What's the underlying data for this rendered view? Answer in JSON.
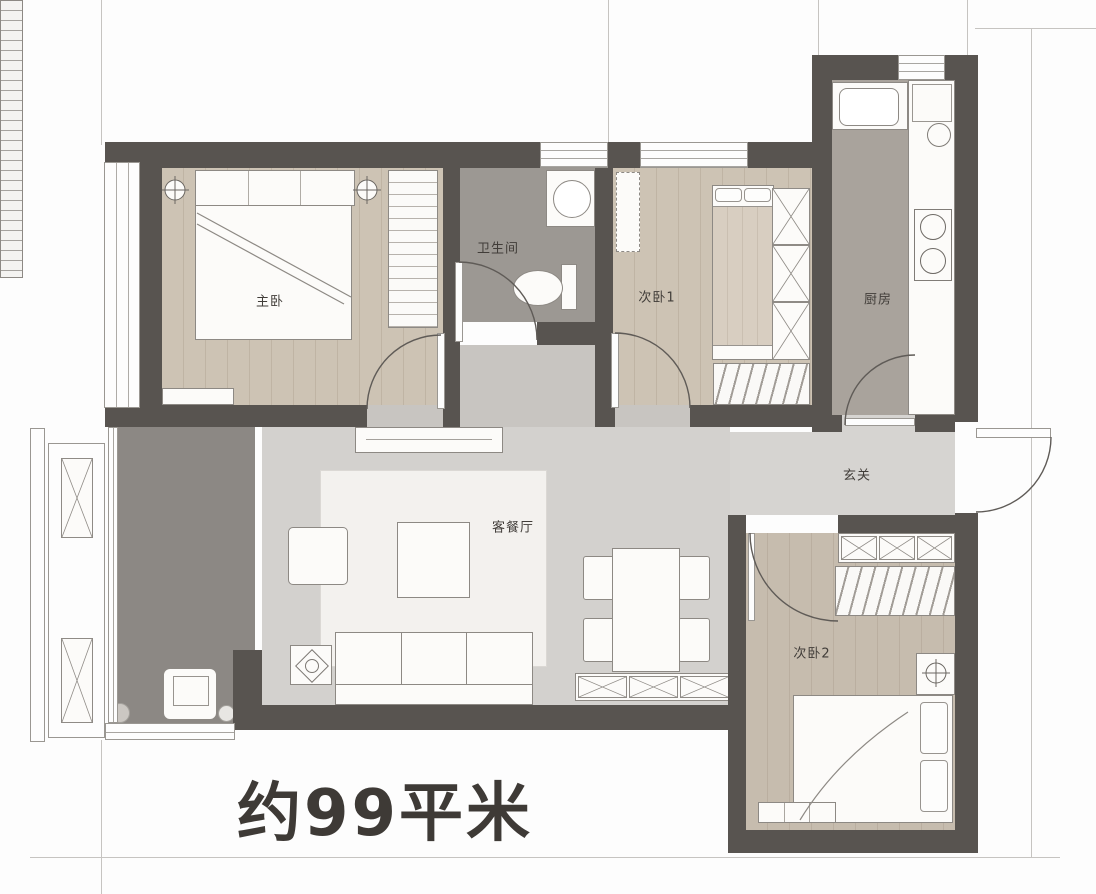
{
  "plan": {
    "area_label": "约99平米",
    "rooms": [
      {
        "id": "master-bedroom",
        "label": "主卧"
      },
      {
        "id": "bathroom",
        "label": "卫生间"
      },
      {
        "id": "bedroom-1",
        "label": "次卧1"
      },
      {
        "id": "kitchen",
        "label": "厨房"
      },
      {
        "id": "foyer",
        "label": "玄关"
      },
      {
        "id": "living-dining",
        "label": "客餐厅"
      },
      {
        "id": "bedroom-2",
        "label": "次卧2"
      }
    ],
    "colors": {
      "wall": "#585450",
      "wood_floor": "#cdc3b4",
      "wood_floor_dark": "#c6bcae",
      "bathroom_tile": "#9c9893",
      "kitchen_floor": "#a9a39c",
      "hall_floor": "#c8c5c1",
      "living_floor": "#d3d1ce",
      "balcony_floor": "#8c8884",
      "label_text": "#413d39",
      "area_text": "#3e3a36"
    }
  }
}
